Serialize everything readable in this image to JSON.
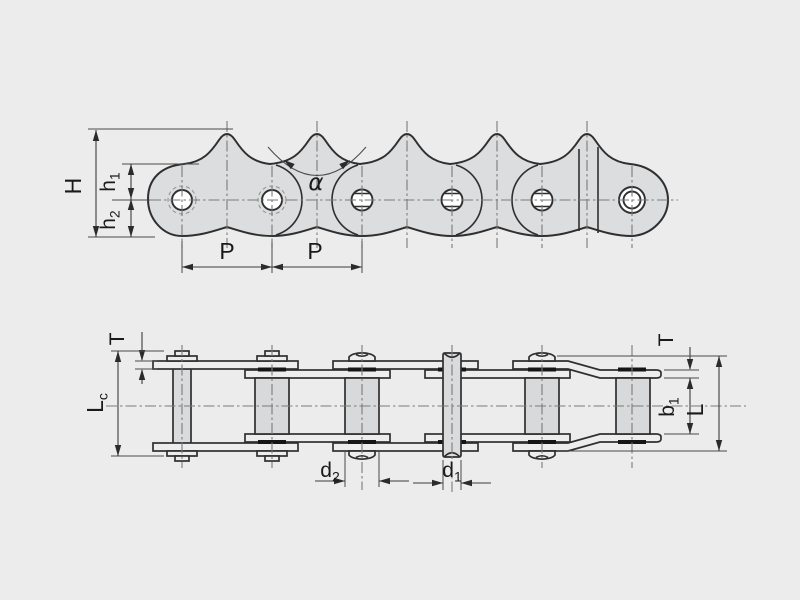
{
  "drawing": {
    "subject": "roller chain with sharp top plates, side view and plan view",
    "colors": {
      "background": "#ECECEC",
      "plate_fill": "#DCDDDE",
      "roller_fill": "#D8D9DB",
      "outline": "#2F2F2F",
      "dimension_line": "#3C3C3C",
      "bushing_mark": "#151515"
    }
  },
  "side_view": {
    "labels": {
      "overall_height": "H",
      "h1": {
        "base": "h",
        "sub": "1"
      },
      "h2": {
        "base": "h",
        "sub": "2"
      },
      "pitch_left": "P",
      "pitch_right": "P",
      "tooth_angle": "α"
    }
  },
  "plan_view": {
    "labels": {
      "plate_thickness_left": "T",
      "pin_length_cotter": {
        "base": "L",
        "sub": "c"
      },
      "roller_diameter": {
        "base": "d",
        "sub": "2"
      },
      "pin_diameter": {
        "base": "d",
        "sub": "1"
      },
      "plate_thickness_right": "T",
      "inner_width": {
        "base": "b",
        "sub": "1"
      },
      "pin_length": "L"
    }
  }
}
